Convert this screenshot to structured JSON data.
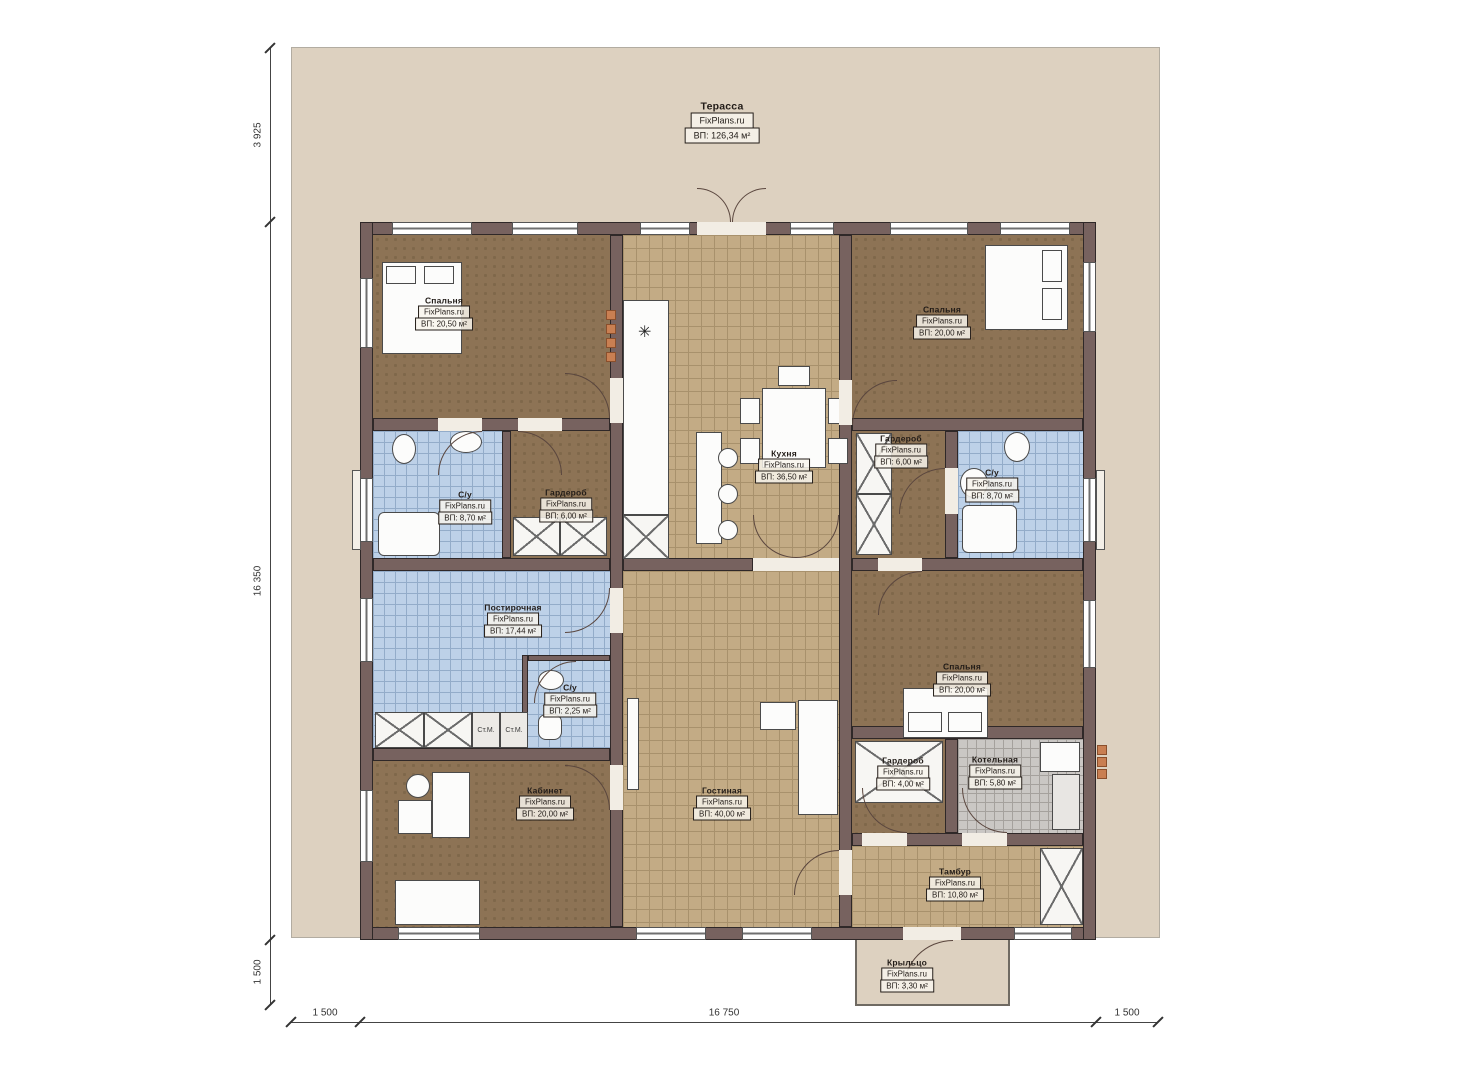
{
  "plan": {
    "source_brand": "FixPlans.ru",
    "units_note": "м²"
  },
  "rooms": [
    {
      "name": "Терасса",
      "brand": "FixPlans.ru",
      "area": "ВП: 126,34 м²"
    },
    {
      "name": "Спальня",
      "brand": "FixPlans.ru",
      "area": "ВП: 20,50 м²"
    },
    {
      "name": "Спальня",
      "brand": "FixPlans.ru",
      "area": "ВП: 20,00 м²"
    },
    {
      "name": "С/у",
      "brand": "FixPlans.ru",
      "area": "ВП: 8,70 м²"
    },
    {
      "name": "Гардероб",
      "brand": "FixPlans.ru",
      "area": "ВП: 6,00 м²"
    },
    {
      "name": "Кухня",
      "brand": "FixPlans.ru",
      "area": "ВП: 36,50 м²"
    },
    {
      "name": "Гардероб",
      "brand": "FixPlans.ru",
      "area": "ВП: 6,00 м²"
    },
    {
      "name": "С/у",
      "brand": "FixPlans.ru",
      "area": "ВП: 8,70 м²"
    },
    {
      "name": "Постирочная",
      "brand": "FixPlans.ru",
      "area": "ВП: 17,44 м²"
    },
    {
      "name": "С/у",
      "brand": "FixPlans.ru",
      "area": "ВП: 2,25 м²"
    },
    {
      "name": "Спальня",
      "brand": "FixPlans.ru",
      "area": "ВП: 20,00 м²"
    },
    {
      "name": "Кабинет",
      "brand": "FixPlans.ru",
      "area": "ВП: 20,00 м²"
    },
    {
      "name": "Гостиная",
      "brand": "FixPlans.ru",
      "area": "ВП: 40,00 м²"
    },
    {
      "name": "Гардероб",
      "brand": "FixPlans.ru",
      "area": "ВП: 4,00 м²"
    },
    {
      "name": "Котельная",
      "brand": "FixPlans.ru",
      "area": "ВП: 5,80 м²"
    },
    {
      "name": "Тамбур",
      "brand": "FixPlans.ru",
      "area": "ВП: 10,80 м²"
    },
    {
      "name": "Крыльцо",
      "brand": "FixPlans.ru",
      "area": "ВП: 3,30 м²"
    }
  ],
  "labels": {
    "washer": "Ст.М."
  },
  "dimensions": {
    "left": [
      "3 925",
      "16 350",
      "1 500"
    ],
    "bottom": [
      "1 500",
      "16 750",
      "1 500"
    ]
  },
  "colors": {
    "plot": "#ddd1c0",
    "wall": "#77625f",
    "floor_wood": "#8d7355",
    "floor_tile_tan": "#c3ab85",
    "floor_tile_blue": "#bdd1e8",
    "floor_tile_gray": "#cac7c4",
    "accent_orange": "#c97f52"
  }
}
